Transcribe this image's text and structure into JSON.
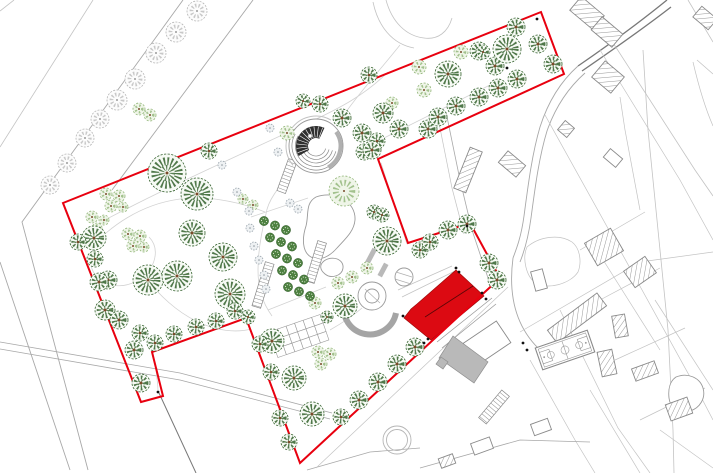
{
  "meta": {
    "drawing_kind": "landscape-masterplan-site-plan",
    "canvas": {
      "w": 713,
      "h": 473
    }
  },
  "colors": {
    "boundary": "#e8000f",
    "building": "#dc0a12",
    "buildingEdge": "#9e0a0a",
    "grayBuilding": "#b9b9b9",
    "parcel": "#c3c3c3",
    "road": "#a8a8a8",
    "darkLine": "#787878",
    "path": "#d2d2d2",
    "feature": "#9a9a9a",
    "treeDark": "#33602c",
    "treeDarkFill": "#f6faf4",
    "treeLight": "#8fb475",
    "treeLightFill": "#eff5e8",
    "treeGray": "#b6b6b6",
    "treeGrayFill": "#fcfcfc",
    "orchard": "#4d8040",
    "orchardEdge": "#2f5a28",
    "dotFill": "#eef1f3",
    "dotStroke": "#9aa5ad",
    "trunk": "#7a4a2a",
    "marker": "#111111"
  },
  "boundary": {
    "points": [
      [
        63,
        203
      ],
      [
        541,
        12
      ],
      [
        564,
        74
      ],
      [
        378,
        159
      ],
      [
        408,
        243
      ],
      [
        470,
        223
      ],
      [
        500,
        278
      ],
      [
        300,
        463
      ],
      [
        246,
        318
      ],
      [
        152,
        352
      ],
      [
        163,
        396
      ],
      [
        141,
        402
      ]
    ]
  },
  "lines": [
    {
      "d": "M14,0 L0,11",
      "w": 0.8,
      "c": "parcel"
    },
    {
      "d": "M93,0 L0,147",
      "w": 0.8,
      "c": "parcel"
    },
    {
      "d": "M183,0 L22,222 L88,470",
      "w": 0.9,
      "c": "road"
    },
    {
      "d": "M253,0 L112,190",
      "w": 0.9,
      "c": "road"
    },
    {
      "d": "M0,262 L70,470",
      "w": 0.9,
      "c": "road"
    },
    {
      "d": "M0,342 L180,373 L332,413",
      "w": 0.8,
      "c": "road"
    },
    {
      "d": "M0,349 L180,380 L330,419",
      "w": 0.8,
      "c": "road"
    },
    {
      "d": "M159,393 L196,473",
      "w": 1,
      "c": "darkLine"
    },
    {
      "d": "M386,0 C392,22 406,36 424,38 C438,40 448,32 452,18",
      "w": 0.8,
      "c": "parcel"
    },
    {
      "d": "M373,2 C378,26 392,44 414,48",
      "w": 0.8,
      "c": "parcel"
    },
    {
      "d": "M667,0 C640,22 610,44 578,66",
      "w": 1.3,
      "c": "darkLine"
    },
    {
      "d": "M671,7 C644,28 614,49 582,71",
      "w": 1.3,
      "c": "darkLine"
    },
    {
      "d": "M578,66 C560,82 548,102 540,127 C532,154 528,186 524,216 C521,238 516,250 513,258",
      "w": 0.9,
      "c": "road"
    },
    {
      "d": "M585,73 C567,89 555,108 547,131 C539,157 535,188 531,218 C528,240 524,252 520,262",
      "w": 0.9,
      "c": "road"
    },
    {
      "d": "M513,258 C508,296 516,326 538,348",
      "w": 0.9,
      "c": "road"
    },
    {
      "d": "M608,35 L695,170 L713,196",
      "w": 0.8,
      "c": "parcel"
    },
    {
      "d": "M643,50 L648,130 L658,230 L668,330 L673,430 L674,473",
      "w": 0.8,
      "c": "parcel"
    },
    {
      "d": "M620,97 L625,130 L640,210",
      "w": 0.7,
      "c": "parcel"
    },
    {
      "d": "M600,50 L680,180 L713,240",
      "w": 0.7,
      "c": "parcel"
    },
    {
      "d": "M688,0 L713,42",
      "w": 0.8,
      "c": "parcel"
    },
    {
      "d": "M697,60 L713,74",
      "w": 0.8,
      "c": "parcel"
    },
    {
      "d": "M693,62 C700,92 706,110 713,126",
      "w": 0.7,
      "c": "parcel"
    },
    {
      "d": "M545,115 L620,250 L700,395 L713,420",
      "w": 0.7,
      "c": "parcel"
    },
    {
      "d": "M560,310 L618,428 L650,473",
      "w": 0.7,
      "c": "parcel"
    },
    {
      "d": "M530,360 L575,440 L595,473",
      "w": 0.7,
      "c": "parcel"
    },
    {
      "d": "M590,390 L640,473",
      "w": 0.7,
      "c": "parcel"
    },
    {
      "d": "M600,255 L660,350",
      "w": 0.7,
      "c": "parcel"
    },
    {
      "d": "M655,300 L713,390",
      "w": 0.7,
      "c": "parcel"
    },
    {
      "d": "M580,250 L645,212",
      "w": 0.7,
      "c": "parcel"
    },
    {
      "d": "M600,300 L660,268",
      "w": 0.7,
      "c": "parcel"
    },
    {
      "d": "M615,360 L685,328",
      "w": 0.7,
      "c": "parcel"
    },
    {
      "d": "M640,420 L705,388",
      "w": 0.7,
      "c": "parcel"
    },
    {
      "d": "M660,430 L713,468",
      "w": 0.7,
      "c": "parcel"
    },
    {
      "d": "M420,468 L520,440 L590,442",
      "w": 0.8,
      "c": "road"
    },
    {
      "d": "M307,470 L370,452 L420,448",
      "w": 0.8,
      "c": "road"
    },
    {
      "d": "M508,287 L316,468",
      "w": 0.7,
      "c": "parcel"
    },
    {
      "d": "M520,332 L640,262 L713,252",
      "w": 0.7,
      "c": "parcel"
    },
    {
      "d": "M527,247 C540,236 560,234 572,242 C580,248 582,262 578,272 C570,284 548,290 536,283 C526,277 522,258 527,247 Z",
      "w": 0.7,
      "c": "parcel"
    },
    {
      "d": "M437,342 L492,298",
      "w": 0.8,
      "c": "feature"
    },
    {
      "d": "M442,348 L496,304",
      "w": 0.8,
      "c": "feature"
    },
    {
      "d": "M398,290 L452,266",
      "w": 0.7,
      "c": "parcel"
    },
    {
      "d": "M402,297 L455,271",
      "w": 0.7,
      "c": "parcel"
    },
    {
      "d": "M381,163 L407,244",
      "w": 0.8,
      "c": "path"
    },
    {
      "d": "M90,228 C160,190 240,155 310,122 C340,108 365,95 388,72",
      "w": 0.8,
      "c": "path"
    },
    {
      "d": "M400,45 C380,70 360,92 346,112",
      "w": 0.8,
      "c": "path"
    },
    {
      "d": "M380,140 C420,120 460,100 500,80",
      "w": 0.8,
      "c": "path"
    },
    {
      "d": "M292,172 C278,188 268,200 266,214 C262,230 258,250 258,270 C258,288 262,302 272,316",
      "w": 0.8,
      "c": "path"
    },
    {
      "d": "M265,212 C235,200 205,196 180,199 C150,203 125,217 106,233",
      "w": 0.8,
      "c": "path"
    },
    {
      "d": "M106,233 C90,247 86,263 96,276 C108,290 130,288 144,276 C157,264 159,247 149,237",
      "w": 0.8,
      "c": "path"
    },
    {
      "d": "M144,276 C160,296 176,311 196,321 C216,331 236,333 251,329",
      "w": 0.8,
      "c": "path"
    },
    {
      "d": "M150,340 C154,356 157,372 158,390",
      "w": 0.8,
      "c": "path"
    },
    {
      "d": "M251,217 L308,198",
      "w": 0.8,
      "c": "path"
    },
    {
      "d": "M268,310 L326,287",
      "w": 0.8,
      "c": "path"
    },
    {
      "d": "M330,330 C344,322 354,315 362,308",
      "w": 0.8,
      "c": "path"
    },
    {
      "d": "M446,112 L460,180 L472,230 L488,278",
      "w": 0.8,
      "c": "road"
    },
    {
      "d": "M438,118 L452,188 L464,234",
      "w": 0.7,
      "c": "parcel"
    }
  ],
  "pond_blobs": [
    "M316,197 C336,190 356,202 355,220 C354,232 344,240 337,248 C330,256 320,262 311,257 C302,252 302,238 306,226 C309,215 305,203 316,197 Z",
    "M324,261 C332,255 344,259 343,268 C342,276 331,279 325,274 C320,270 319,265 324,261 Z",
    "M676,377 C688,372 700,378 703,388 C706,398 700,408 690,411 C680,414 670,408 669,398 C668,389 670,381 676,377 Z"
  ],
  "circle_features": [
    {
      "cx": 397,
      "cy": 440,
      "r": 14
    },
    {
      "cx": 397,
      "cy": 440,
      "r": 10.5
    }
  ],
  "outside_buildings": [
    {
      "cx": 587,
      "cy": 13,
      "w": 30,
      "h": 18,
      "rot": 40,
      "hatched": true
    },
    {
      "cx": 607,
      "cy": 32,
      "w": 27,
      "h": 17,
      "rot": 40,
      "hatched": true
    },
    {
      "cx": 608,
      "cy": 77,
      "w": 25,
      "h": 21,
      "rot": 40,
      "hatched": true
    },
    {
      "cx": 566,
      "cy": 129,
      "w": 12,
      "h": 12,
      "rot": 40,
      "hatched": true
    },
    {
      "cx": 512,
      "cy": 164,
      "w": 23,
      "h": 15,
      "rot": 40,
      "hatched": true
    },
    {
      "cx": 468,
      "cy": 170,
      "w": 13,
      "h": 44,
      "rot": 22,
      "hatched": true
    },
    {
      "cx": 705,
      "cy": 18,
      "w": 20,
      "h": 14,
      "rot": 40,
      "hatched": true
    },
    {
      "cx": 604,
      "cy": 247,
      "w": 30,
      "h": 26,
      "rot": -30,
      "hatched": true
    },
    {
      "cx": 640,
      "cy": 272,
      "w": 26,
      "h": 20,
      "rot": -35,
      "hatched": true
    },
    {
      "cx": 577,
      "cy": 318,
      "w": 62,
      "h": 16,
      "rot": -37,
      "hatched": true
    },
    {
      "cx": 620,
      "cy": 326,
      "w": 13,
      "h": 22,
      "rot": -10,
      "hatched": true
    },
    {
      "cx": 607,
      "cy": 363,
      "w": 15,
      "h": 25,
      "rot": -12,
      "hatched": true
    },
    {
      "cx": 645,
      "cy": 371,
      "w": 24,
      "h": 13,
      "rot": -20,
      "hatched": true
    },
    {
      "cx": 679,
      "cy": 409,
      "w": 23,
      "h": 17,
      "rot": -20,
      "hatched": true
    },
    {
      "cx": 447,
      "cy": 461,
      "w": 15,
      "h": 10,
      "rot": -20,
      "hatched": true
    },
    {
      "cx": 539,
      "cy": 280,
      "w": 12,
      "h": 20,
      "rot": -15,
      "hatched": false
    },
    {
      "cx": 613,
      "cy": 158,
      "w": 16,
      "h": 11,
      "rot": 40,
      "hatched": false
    },
    {
      "cx": 541,
      "cy": 427,
      "w": 18,
      "h": 12,
      "rot": -20,
      "hatched": false
    },
    {
      "cx": 482,
      "cy": 446,
      "w": 20,
      "h": 12,
      "rot": -20,
      "hatched": false
    },
    {
      "cx": 487,
      "cy": 343,
      "w": 40,
      "h": 26,
      "rot": -34,
      "hatched": false
    }
  ],
  "court": {
    "cx": 565,
    "cy": 350,
    "w": 55,
    "h": 23,
    "rot": -19
  },
  "red_building": {
    "points": [
      [
        456,
        270
      ],
      [
        484,
        296
      ],
      [
        431,
        340
      ],
      [
        404,
        318
      ],
      [
        411,
        309
      ],
      [
        417,
        304
      ]
    ],
    "ridge": [
      [
        425,
        317
      ],
      [
        473,
        286
      ]
    ]
  },
  "gray_buildings": [
    {
      "points": [
        [
          453,
          336
        ],
        [
          488,
          362
        ],
        [
          474,
          383
        ],
        [
          439,
          358
        ]
      ]
    },
    {
      "points": [
        [
          441,
          357
        ],
        [
          448,
          362
        ],
        [
          443,
          369
        ],
        [
          436,
          364
        ]
      ]
    }
  ],
  "ladders": [
    {
      "x": 287,
      "y": 176,
      "len": 34,
      "w": 9,
      "rot": 20
    },
    {
      "x": 263,
      "y": 285,
      "len": 46,
      "w": 9,
      "rot": 17
    },
    {
      "x": 316,
      "y": 262,
      "len": 42,
      "w": 9,
      "rot": 17
    },
    {
      "x": 494,
      "y": 407,
      "len": 36,
      "w": 10,
      "rot": 40
    }
  ],
  "parterre": {
    "cx": 299,
    "cy": 336,
    "cols": 6,
    "rows": 3,
    "cell": 9,
    "rot": -19
  },
  "orchard": {
    "ox": 264,
    "oy": 221,
    "ax": 11,
    "ay": 4.5,
    "bx": 6,
    "by": 16.5,
    "cols": 3,
    "rows": 5,
    "r": 4.6
  },
  "amphitheatre": {
    "cx": 316,
    "cy": 146,
    "r": 27
  },
  "garden_feature": {
    "circles": [
      {
        "cx": 372,
        "cy": 296,
        "r": 14
      },
      {
        "cx": 372,
        "cy": 296,
        "r": 7
      },
      {
        "cx": 404,
        "cy": 277,
        "r": 9
      }
    ],
    "detail_lines": [
      {
        "d": "M396,272 L412,277"
      },
      {
        "d": "M395,279 L411,284"
      },
      {
        "d": "M365,289 L380,303"
      }
    ],
    "arcs": [
      {
        "d": "M344,303 A26,26 0 0 0 396,313",
        "w": 6
      }
    ],
    "bars": [
      {
        "cx": 371,
        "cy": 256,
        "w": 5,
        "h": 16,
        "rot": 28
      },
      {
        "cx": 383,
        "cy": 270,
        "w": 5,
        "h": 14,
        "rot": 28
      }
    ]
  },
  "survey_markers": [
    [
      507,
      68
    ],
    [
      537,
      19
    ],
    [
      456,
      268
    ],
    [
      459,
      272
    ],
    [
      482,
      293
    ],
    [
      486,
      299
    ],
    [
      428,
      339
    ],
    [
      424,
      343
    ],
    [
      403,
      316
    ],
    [
      523,
      343
    ],
    [
      527,
      350
    ],
    [
      158,
      392
    ],
    [
      467,
      226
    ]
  ],
  "trees": {
    "gray_avenue": [
      [
        197,
        11,
        10
      ],
      [
        176,
        32,
        10
      ],
      [
        156,
        53,
        10
      ],
      [
        135,
        79,
        10
      ],
      [
        117,
        100,
        10
      ],
      [
        100,
        119,
        9
      ],
      [
        85,
        138,
        9
      ],
      [
        67,
        163,
        9
      ],
      [
        50,
        185,
        9
      ]
    ],
    "dark": [
      [
        369,
        75,
        8
      ],
      [
        383,
        113,
        10
      ],
      [
        399,
        129,
        9
      ],
      [
        428,
        129,
        9
      ],
      [
        377,
        141,
        8
      ],
      [
        364,
        152,
        8
      ],
      [
        448,
        74,
        13
      ],
      [
        479,
        51,
        9
      ],
      [
        495,
        66,
        9
      ],
      [
        507,
        49,
        14
      ],
      [
        516,
        27,
        9
      ],
      [
        538,
        44,
        9
      ],
      [
        553,
        64,
        9
      ],
      [
        517,
        79,
        9
      ],
      [
        498,
        88,
        9
      ],
      [
        456,
        106,
        9
      ],
      [
        438,
        117,
        9
      ],
      [
        479,
        97,
        9
      ],
      [
        483,
        52,
        7
      ],
      [
        209,
        151,
        8
      ],
      [
        167,
        173,
        19
      ],
      [
        197,
        194,
        16
      ],
      [
        94,
        238,
        12
      ],
      [
        192,
        233,
        13
      ],
      [
        223,
        257,
        14
      ],
      [
        148,
        280,
        15
      ],
      [
        177,
        276,
        15
      ],
      [
        230,
        294,
        15
      ],
      [
        108,
        280,
        9
      ],
      [
        105,
        310,
        10
      ],
      [
        95,
        259,
        8
      ],
      [
        140,
        333,
        8
      ],
      [
        342,
        118,
        9
      ],
      [
        362,
        133,
        9
      ],
      [
        372,
        150,
        9
      ],
      [
        320,
        104,
        8
      ],
      [
        303,
        101,
        7
      ],
      [
        387,
        241,
        14
      ],
      [
        374,
        212,
        7
      ],
      [
        382,
        215,
        7
      ],
      [
        345,
        306,
        12
      ],
      [
        327,
        317,
        6
      ],
      [
        272,
        341,
        12
      ],
      [
        294,
        378,
        12
      ],
      [
        312,
        414,
        12
      ],
      [
        78,
        242,
        8
      ],
      [
        99,
        282,
        9
      ],
      [
        119,
        320,
        9
      ],
      [
        134,
        350,
        9
      ],
      [
        141,
        383,
        9
      ],
      [
        235,
        311,
        8
      ],
      [
        216,
        321,
        8
      ],
      [
        196,
        327,
        8
      ],
      [
        174,
        334,
        8
      ],
      [
        155,
        343,
        8
      ],
      [
        248,
        317,
        7
      ],
      [
        260,
        344,
        8
      ],
      [
        271,
        372,
        8
      ],
      [
        280,
        418,
        8
      ],
      [
        289,
        442,
        8
      ],
      [
        415,
        347,
        9
      ],
      [
        397,
        364,
        9
      ],
      [
        378,
        382,
        9
      ],
      [
        359,
        400,
        9
      ],
      [
        341,
        417,
        8
      ],
      [
        420,
        250,
        8
      ],
      [
        430,
        242,
        8
      ],
      [
        448,
        230,
        9
      ],
      [
        467,
        224,
        9
      ],
      [
        489,
        263,
        9
      ],
      [
        497,
        280,
        9
      ]
    ],
    "light": [
      [
        419,
        67,
        7
      ],
      [
        461,
        52,
        7
      ],
      [
        424,
        90,
        7
      ],
      [
        392,
        103,
        6
      ],
      [
        287,
        133,
        7
      ],
      [
        106,
        194,
        6
      ],
      [
        119,
        196,
        6
      ],
      [
        111,
        206,
        6
      ],
      [
        123,
        207,
        5
      ],
      [
        92,
        217,
        6
      ],
      [
        104,
        220,
        5
      ],
      [
        97,
        228,
        5
      ],
      [
        128,
        234,
        6
      ],
      [
        140,
        236,
        6
      ],
      [
        133,
        246,
        6
      ],
      [
        144,
        247,
        5
      ],
      [
        139,
        109,
        6
      ],
      [
        150,
        115,
        6
      ],
      [
        243,
        199,
        5
      ],
      [
        253,
        205,
        5
      ],
      [
        344,
        191,
        15
      ],
      [
        367,
        268,
        6
      ],
      [
        352,
        277,
        6
      ],
      [
        338,
        283,
        6
      ],
      [
        315,
        303,
        6
      ],
      [
        318,
        352,
        6
      ],
      [
        330,
        354,
        6
      ],
      [
        321,
        364,
        6
      ]
    ],
    "gray_small": [
      [
        270,
        128,
        4
      ],
      [
        278,
        152,
        4
      ],
      [
        222,
        165,
        4
      ],
      [
        237,
        192,
        4
      ],
      [
        290,
        203,
        4
      ],
      [
        298,
        209,
        4
      ],
      [
        249,
        211,
        4
      ],
      [
        250,
        228,
        4
      ],
      [
        254,
        246,
        4
      ],
      [
        259,
        260,
        4
      ],
      [
        264,
        275,
        4
      ],
      [
        266,
        289,
        4
      ]
    ]
  }
}
